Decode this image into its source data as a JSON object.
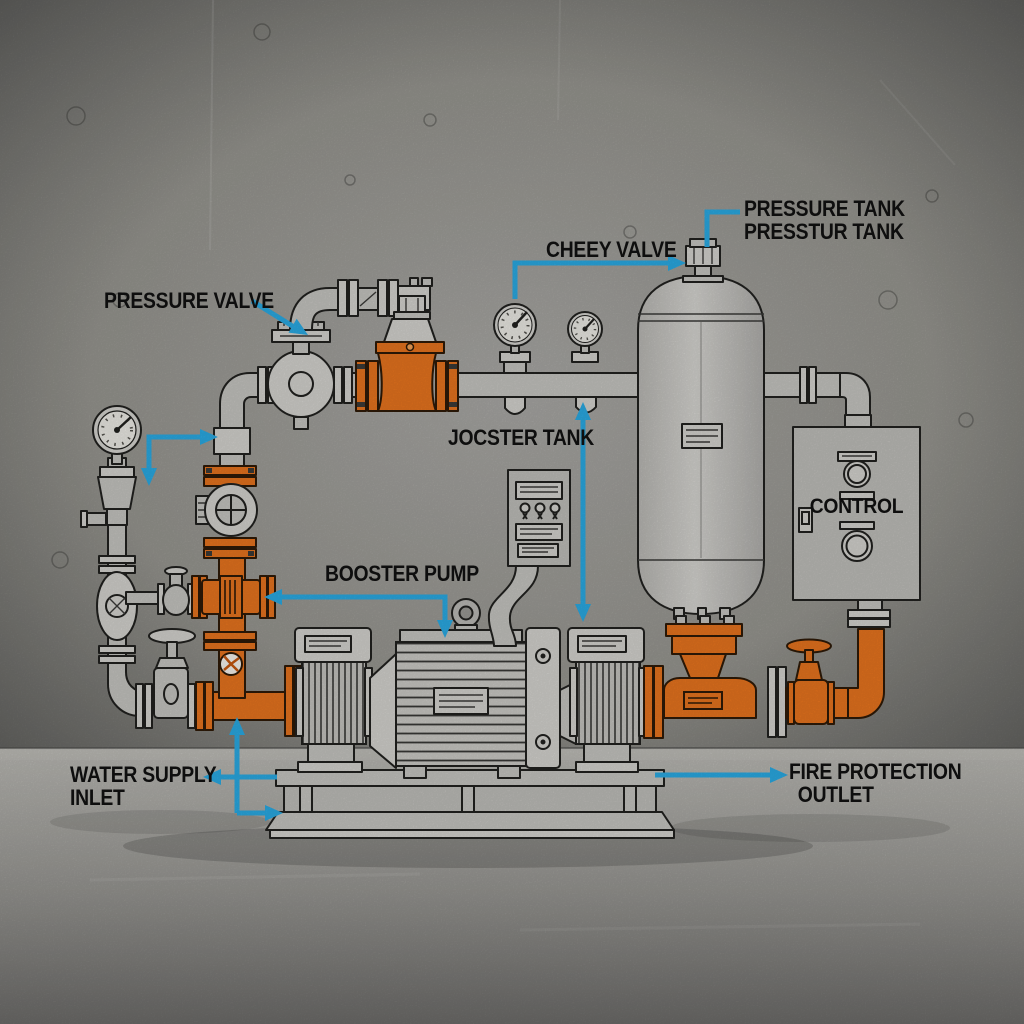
{
  "colors": {
    "highlight_orange": "#e5731e",
    "annotation_blue": "#2aa9e2",
    "label_black": "#0e0e0e"
  },
  "callouts": {
    "pressure_valve": "PRESSURE VALVE",
    "cheey_valve": "CHEEY VALVE",
    "pressure_tank": {
      "line1": "PRESSURE TANK",
      "line2": "PRESSTUR TANK"
    },
    "jocster_tank": "JOCSTER TANK",
    "booster_pump": "BOOSTER PUMP",
    "control": "CONTROL",
    "water_supply": {
      "line1": "WATER SUPPLY",
      "line2": "INLET"
    },
    "fire_protection": {
      "line1": "FIRE PROTECTION",
      "line2": "OUTLET"
    }
  },
  "equipment_icons": [
    "pressure-gauge-icon",
    "pressure-regulator-icon",
    "sight-check-valve-icon",
    "jockey-pump-icon",
    "relief-valve-icon",
    "check-valve-icon",
    "pipe-gauge-icons",
    "pressure-tank-icon",
    "tank-valve-icon",
    "gate-valve-icon",
    "handwheel-valve-icon",
    "control-panel-icon",
    "jockey-controller-icon",
    "motor-icon",
    "pump-skid-icon"
  ]
}
